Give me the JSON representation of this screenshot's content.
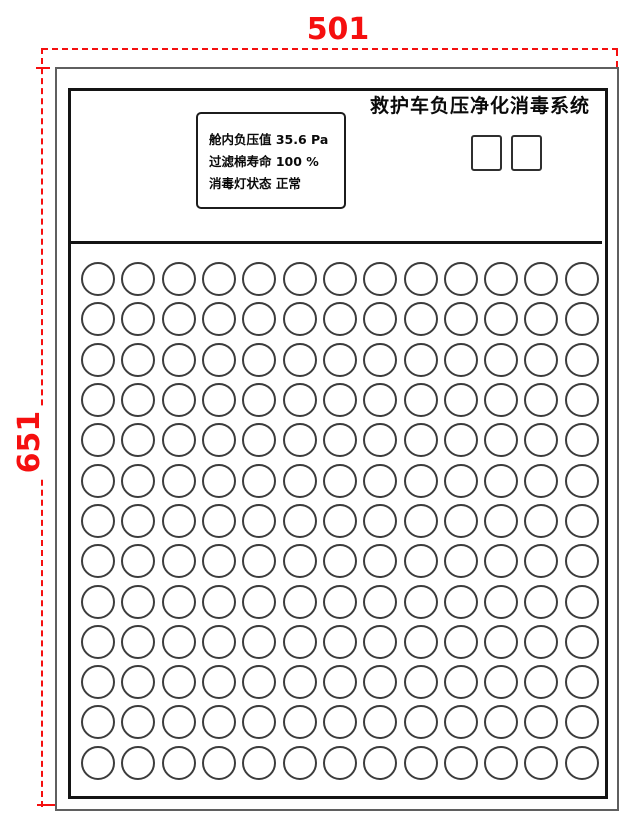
{
  "dimensions": {
    "width_label": "501",
    "height_label": "651",
    "line_color": "#f50f0f"
  },
  "panel": {
    "title": "救护车负压净化消毒系统",
    "display": {
      "lines": [
        "舱内负压值 35.6 Pa",
        "过滤棉寿命 100 %",
        "消毒灯状态 正常"
      ]
    },
    "buttons": [
      {
        "label": ""
      },
      {
        "label": ""
      }
    ],
    "grid": {
      "rows": 13,
      "cols": 13
    }
  }
}
